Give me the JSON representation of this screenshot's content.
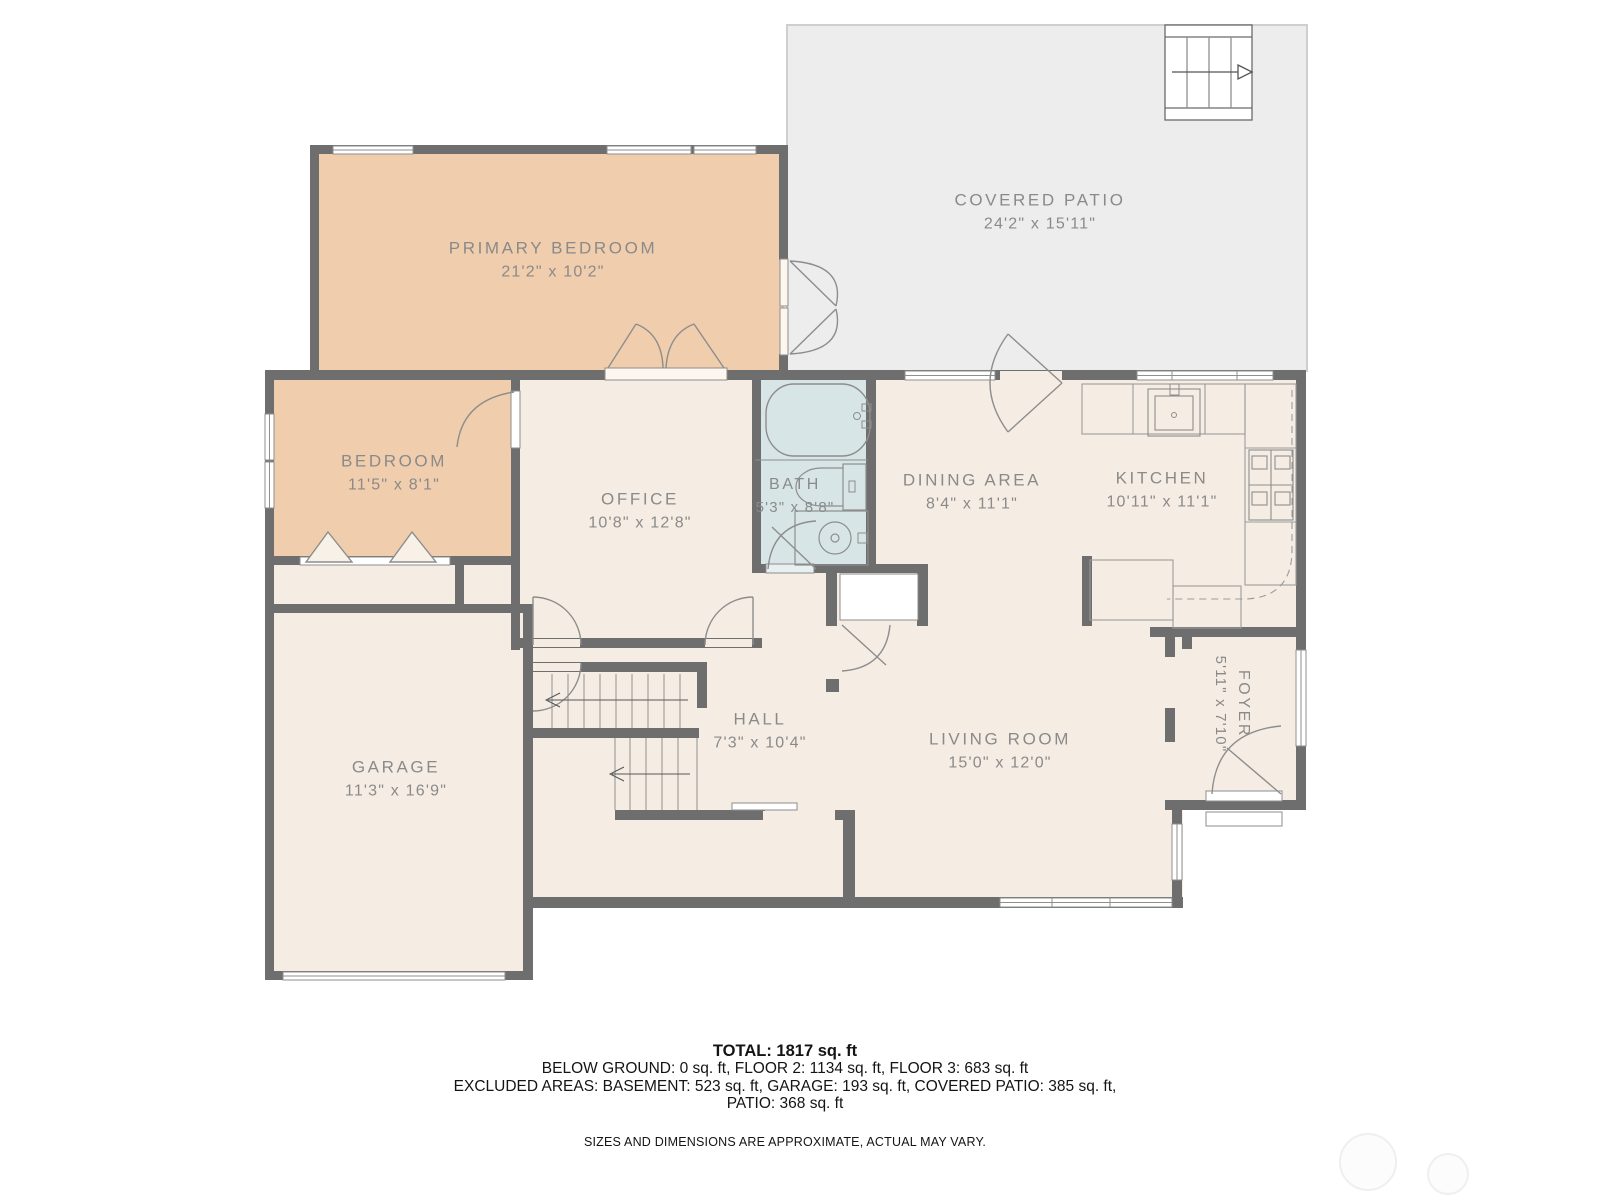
{
  "rooms": {
    "covered_patio": {
      "name": "COVERED PATIO",
      "dims": "24'2\" x 15'11\""
    },
    "primary_bedroom": {
      "name": "PRIMARY BEDROOM",
      "dims": "21'2\" x 10'2\""
    },
    "bedroom": {
      "name": "BEDROOM",
      "dims": "11'5\" x 8'1\""
    },
    "office": {
      "name": "OFFICE",
      "dims": "10'8\" x 12'8\""
    },
    "bath": {
      "name": "BATH",
      "dims": "5'3\" x 8'8\""
    },
    "dining_area": {
      "name": "DINING AREA",
      "dims": "8'4\" x 11'1\""
    },
    "kitchen": {
      "name": "KITCHEN",
      "dims": "10'11\" x 11'1\""
    },
    "garage": {
      "name": "GARAGE",
      "dims": "11'3\" x 16'9\""
    },
    "hall": {
      "name": "HALL",
      "dims": "7'3\" x 10'4\""
    },
    "living_room": {
      "name": "LIVING ROOM",
      "dims": "15'0\" x 12'0\""
    },
    "foyer": {
      "name": "FOYER",
      "dims": "5'11\" x 7'10\""
    }
  },
  "summary": {
    "total": "TOTAL: 1817 sq. ft",
    "floors": "BELOW GROUND: 0 sq. ft, FLOOR 2: 1134 sq. ft, FLOOR 3: 683 sq. ft",
    "excluded": "EXCLUDED AREAS: BASEMENT: 523 sq. ft, GARAGE: 193 sq. ft, COVERED PATIO: 385 sq. ft,",
    "excluded_cont": "PATIO: 368 sq. ft",
    "disclaimer": "SIZES AND DIMENSIONS ARE APPROXIMATE, ACTUAL MAY VARY."
  },
  "colors": {
    "wall": "#6e6e6e",
    "room_fill": "#f5ede3",
    "bedroom_fill": "#f0cdac",
    "bath_fill": "#d8e5e7",
    "patio_fill": "#ededee",
    "label_text": "#8a8a8a",
    "fixture_line": "#8d8d8d",
    "footer_text": "#141414"
  }
}
